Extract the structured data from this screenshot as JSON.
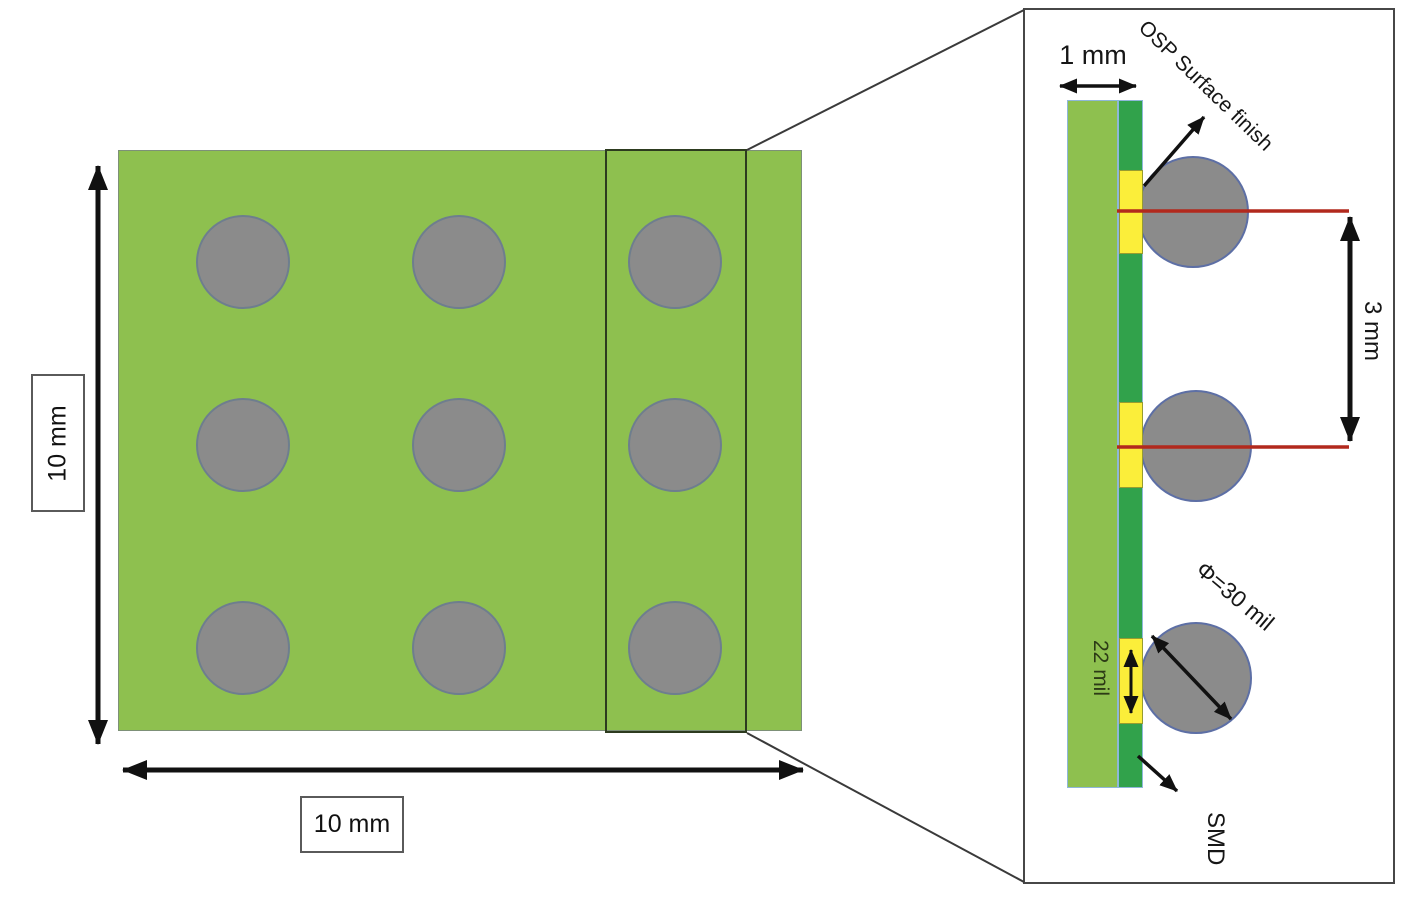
{
  "top_view": {
    "description": "PCB top view with 3x3 grid of circular pads",
    "width_label": "10 mm",
    "height_label": "10 mm",
    "pad_rows": 3,
    "pad_cols": 3
  },
  "detail_view": {
    "description": "Zoomed cross-section of right pad column",
    "thickness_label": "1 mm",
    "surface_finish_label": "OSP Surface finish",
    "pitch_label": "3 mm",
    "pad_width_label": "22 mil",
    "ball_diameter_label": "Φ=30 mil",
    "mount_type_label": "SMD"
  },
  "colors": {
    "board_green": "#8ec04f",
    "solder_mask_green": "#31a24b",
    "pad_yellow": "#fbee3a",
    "ball_gray": "#8b8b8b",
    "ball_border_blue": "#5d6fa5",
    "reference_line_red": "#b2291d"
  }
}
